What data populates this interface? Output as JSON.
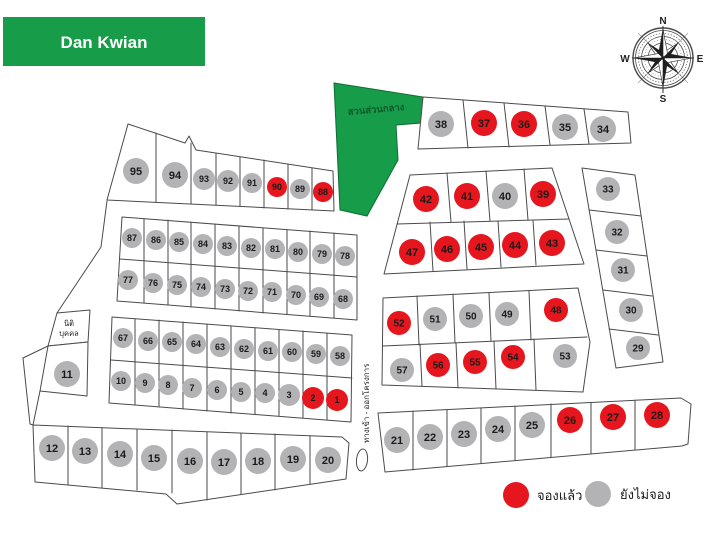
{
  "title": {
    "label": "Dan Kwian"
  },
  "compass": {
    "north": "N",
    "east": "E",
    "south": "S",
    "west": "W"
  },
  "labels": {
    "central_garden": "สวนส่วนกลาง",
    "entrance_road": "ทางเข้า - ออกโครงการ",
    "adjacent_land_line1": "นิติ",
    "adjacent_land_line2": "บุคคล"
  },
  "legend": {
    "reserved_label": "จองแล้ว",
    "available_label": "ยังไม่จอง"
  },
  "colors": {
    "reserved": "#e5161d",
    "available": "#b3b3b5",
    "brand_green": "#179c4a",
    "outline": "#4a4a4a"
  },
  "plots": [
    {
      "no": 95,
      "x": 136,
      "y": 171,
      "r": 13,
      "status": "available"
    },
    {
      "no": 94,
      "x": 175,
      "y": 175,
      "r": 13,
      "status": "available"
    },
    {
      "no": 93,
      "x": 204,
      "y": 179,
      "r": 11,
      "status": "available"
    },
    {
      "no": 92,
      "x": 228,
      "y": 181,
      "r": 11,
      "status": "available"
    },
    {
      "no": 91,
      "x": 252,
      "y": 183,
      "r": 10,
      "status": "available"
    },
    {
      "no": 90,
      "x": 277,
      "y": 187,
      "r": 10,
      "status": "reserved"
    },
    {
      "no": 89,
      "x": 300,
      "y": 189,
      "r": 10,
      "status": "available"
    },
    {
      "no": 88,
      "x": 323,
      "y": 192,
      "r": 10,
      "status": "reserved"
    },
    {
      "no": 87,
      "x": 132,
      "y": 238,
      "r": 10,
      "status": "available"
    },
    {
      "no": 86,
      "x": 156,
      "y": 240,
      "r": 10,
      "status": "available"
    },
    {
      "no": 85,
      "x": 179,
      "y": 242,
      "r": 10,
      "status": "available"
    },
    {
      "no": 84,
      "x": 203,
      "y": 244,
      "r": 10,
      "status": "available"
    },
    {
      "no": 83,
      "x": 227,
      "y": 246,
      "r": 10,
      "status": "available"
    },
    {
      "no": 82,
      "x": 251,
      "y": 248,
      "r": 10,
      "status": "available"
    },
    {
      "no": 81,
      "x": 275,
      "y": 249,
      "r": 10,
      "status": "available"
    },
    {
      "no": 80,
      "x": 298,
      "y": 252,
      "r": 10,
      "status": "available"
    },
    {
      "no": 79,
      "x": 322,
      "y": 254,
      "r": 10,
      "status": "available"
    },
    {
      "no": 78,
      "x": 345,
      "y": 256,
      "r": 10,
      "status": "available"
    },
    {
      "no": 77,
      "x": 128,
      "y": 280,
      "r": 10,
      "status": "available"
    },
    {
      "no": 76,
      "x": 153,
      "y": 283,
      "r": 10,
      "status": "available"
    },
    {
      "no": 75,
      "x": 177,
      "y": 285,
      "r": 10,
      "status": "available"
    },
    {
      "no": 74,
      "x": 201,
      "y": 287,
      "r": 10,
      "status": "available"
    },
    {
      "no": 73,
      "x": 225,
      "y": 289,
      "r": 10,
      "status": "available"
    },
    {
      "no": 72,
      "x": 248,
      "y": 291,
      "r": 10,
      "status": "available"
    },
    {
      "no": 71,
      "x": 272,
      "y": 292,
      "r": 10,
      "status": "available"
    },
    {
      "no": 70,
      "x": 296,
      "y": 295,
      "r": 10,
      "status": "available"
    },
    {
      "no": 69,
      "x": 319,
      "y": 297,
      "r": 10,
      "status": "available"
    },
    {
      "no": 68,
      "x": 343,
      "y": 299,
      "r": 10,
      "status": "available"
    },
    {
      "no": 67,
      "x": 123,
      "y": 338,
      "r": 10,
      "status": "available"
    },
    {
      "no": 66,
      "x": 148,
      "y": 341,
      "r": 10,
      "status": "available"
    },
    {
      "no": 65,
      "x": 172,
      "y": 342,
      "r": 10,
      "status": "available"
    },
    {
      "no": 64,
      "x": 196,
      "y": 344,
      "r": 10,
      "status": "available"
    },
    {
      "no": 63,
      "x": 220,
      "y": 347,
      "r": 10,
      "status": "available"
    },
    {
      "no": 62,
      "x": 244,
      "y": 349,
      "r": 10,
      "status": "available"
    },
    {
      "no": 61,
      "x": 268,
      "y": 351,
      "r": 10,
      "status": "available"
    },
    {
      "no": 60,
      "x": 292,
      "y": 352,
      "r": 10,
      "status": "available"
    },
    {
      "no": 59,
      "x": 316,
      "y": 354,
      "r": 10,
      "status": "available"
    },
    {
      "no": 58,
      "x": 340,
      "y": 356,
      "r": 10,
      "status": "available"
    },
    {
      "no": 10,
      "x": 121,
      "y": 381,
      "r": 10,
      "status": "available"
    },
    {
      "no": 9,
      "x": 145,
      "y": 383,
      "r": 10,
      "status": "available"
    },
    {
      "no": 8,
      "x": 168,
      "y": 385,
      "r": 10,
      "status": "available"
    },
    {
      "no": 7,
      "x": 192,
      "y": 388,
      "r": 10,
      "status": "available"
    },
    {
      "no": 6,
      "x": 217,
      "y": 390,
      "r": 10,
      "status": "available"
    },
    {
      "no": 5,
      "x": 241,
      "y": 392,
      "r": 10,
      "status": "available"
    },
    {
      "no": 4,
      "x": 265,
      "y": 393,
      "r": 10,
      "status": "available"
    },
    {
      "no": 3,
      "x": 289,
      "y": 395,
      "r": 11,
      "status": "available"
    },
    {
      "no": 2,
      "x": 313,
      "y": 398,
      "r": 11,
      "status": "reserved"
    },
    {
      "no": 1,
      "x": 337,
      "y": 400,
      "r": 11,
      "status": "reserved"
    },
    {
      "no": 11,
      "x": 67,
      "y": 374,
      "r": 13,
      "status": "available"
    },
    {
      "no": 12,
      "x": 52,
      "y": 448,
      "r": 13,
      "status": "available"
    },
    {
      "no": 13,
      "x": 85,
      "y": 451,
      "r": 13,
      "status": "available"
    },
    {
      "no": 14,
      "x": 120,
      "y": 454,
      "r": 13,
      "status": "available"
    },
    {
      "no": 15,
      "x": 154,
      "y": 458,
      "r": 13,
      "status": "available"
    },
    {
      "no": 16,
      "x": 190,
      "y": 461,
      "r": 13,
      "status": "available"
    },
    {
      "no": 17,
      "x": 224,
      "y": 462,
      "r": 13,
      "status": "available"
    },
    {
      "no": 18,
      "x": 258,
      "y": 461,
      "r": 13,
      "status": "available"
    },
    {
      "no": 19,
      "x": 293,
      "y": 459,
      "r": 13,
      "status": "available"
    },
    {
      "no": 20,
      "x": 328,
      "y": 460,
      "r": 13,
      "status": "available"
    },
    {
      "no": 38,
      "x": 441,
      "y": 124,
      "r": 13,
      "status": "available"
    },
    {
      "no": 37,
      "x": 484,
      "y": 123,
      "r": 13,
      "status": "reserved"
    },
    {
      "no": 36,
      "x": 524,
      "y": 124,
      "r": 13,
      "status": "reserved"
    },
    {
      "no": 35,
      "x": 565,
      "y": 127,
      "r": 13,
      "status": "available"
    },
    {
      "no": 34,
      "x": 603,
      "y": 129,
      "r": 13,
      "status": "available"
    },
    {
      "no": 42,
      "x": 426,
      "y": 199,
      "r": 13,
      "status": "reserved"
    },
    {
      "no": 41,
      "x": 467,
      "y": 196,
      "r": 13,
      "status": "reserved"
    },
    {
      "no": 40,
      "x": 505,
      "y": 196,
      "r": 13,
      "status": "available"
    },
    {
      "no": 39,
      "x": 543,
      "y": 194,
      "r": 13,
      "status": "reserved"
    },
    {
      "no": 47,
      "x": 412,
      "y": 252,
      "r": 13,
      "status": "reserved"
    },
    {
      "no": 46,
      "x": 447,
      "y": 249,
      "r": 13,
      "status": "reserved"
    },
    {
      "no": 45,
      "x": 481,
      "y": 247,
      "r": 13,
      "status": "reserved"
    },
    {
      "no": 44,
      "x": 515,
      "y": 245,
      "r": 13,
      "status": "reserved"
    },
    {
      "no": 43,
      "x": 552,
      "y": 243,
      "r": 13,
      "status": "reserved"
    },
    {
      "no": 33,
      "x": 608,
      "y": 189,
      "r": 12,
      "status": "available"
    },
    {
      "no": 32,
      "x": 617,
      "y": 232,
      "r": 12,
      "status": "available"
    },
    {
      "no": 31,
      "x": 623,
      "y": 270,
      "r": 12,
      "status": "available"
    },
    {
      "no": 30,
      "x": 631,
      "y": 310,
      "r": 12,
      "status": "available"
    },
    {
      "no": 29,
      "x": 638,
      "y": 348,
      "r": 12,
      "status": "available"
    },
    {
      "no": 52,
      "x": 399,
      "y": 323,
      "r": 12,
      "status": "reserved"
    },
    {
      "no": 51,
      "x": 435,
      "y": 319,
      "r": 12,
      "status": "available"
    },
    {
      "no": 50,
      "x": 471,
      "y": 316,
      "r": 12,
      "status": "available"
    },
    {
      "no": 49,
      "x": 507,
      "y": 314,
      "r": 12,
      "status": "available"
    },
    {
      "no": 48,
      "x": 556,
      "y": 310,
      "r": 12,
      "status": "reserved"
    },
    {
      "no": 57,
      "x": 402,
      "y": 370,
      "r": 12,
      "status": "available"
    },
    {
      "no": 56,
      "x": 438,
      "y": 365,
      "r": 12,
      "status": "reserved"
    },
    {
      "no": 55,
      "x": 475,
      "y": 362,
      "r": 12,
      "status": "reserved"
    },
    {
      "no": 54,
      "x": 513,
      "y": 357,
      "r": 12,
      "status": "reserved"
    },
    {
      "no": 53,
      "x": 565,
      "y": 356,
      "r": 12,
      "status": "available"
    },
    {
      "no": 21,
      "x": 397,
      "y": 440,
      "r": 13,
      "status": "available"
    },
    {
      "no": 22,
      "x": 430,
      "y": 437,
      "r": 13,
      "status": "available"
    },
    {
      "no": 23,
      "x": 464,
      "y": 434,
      "r": 13,
      "status": "available"
    },
    {
      "no": 24,
      "x": 498,
      "y": 429,
      "r": 13,
      "status": "available"
    },
    {
      "no": 25,
      "x": 532,
      "y": 425,
      "r": 13,
      "status": "available"
    },
    {
      "no": 26,
      "x": 570,
      "y": 420,
      "r": 13,
      "status": "reserved"
    },
    {
      "no": 27,
      "x": 613,
      "y": 417,
      "r": 13,
      "status": "reserved"
    },
    {
      "no": 28,
      "x": 657,
      "y": 415,
      "r": 13,
      "status": "reserved"
    }
  ]
}
